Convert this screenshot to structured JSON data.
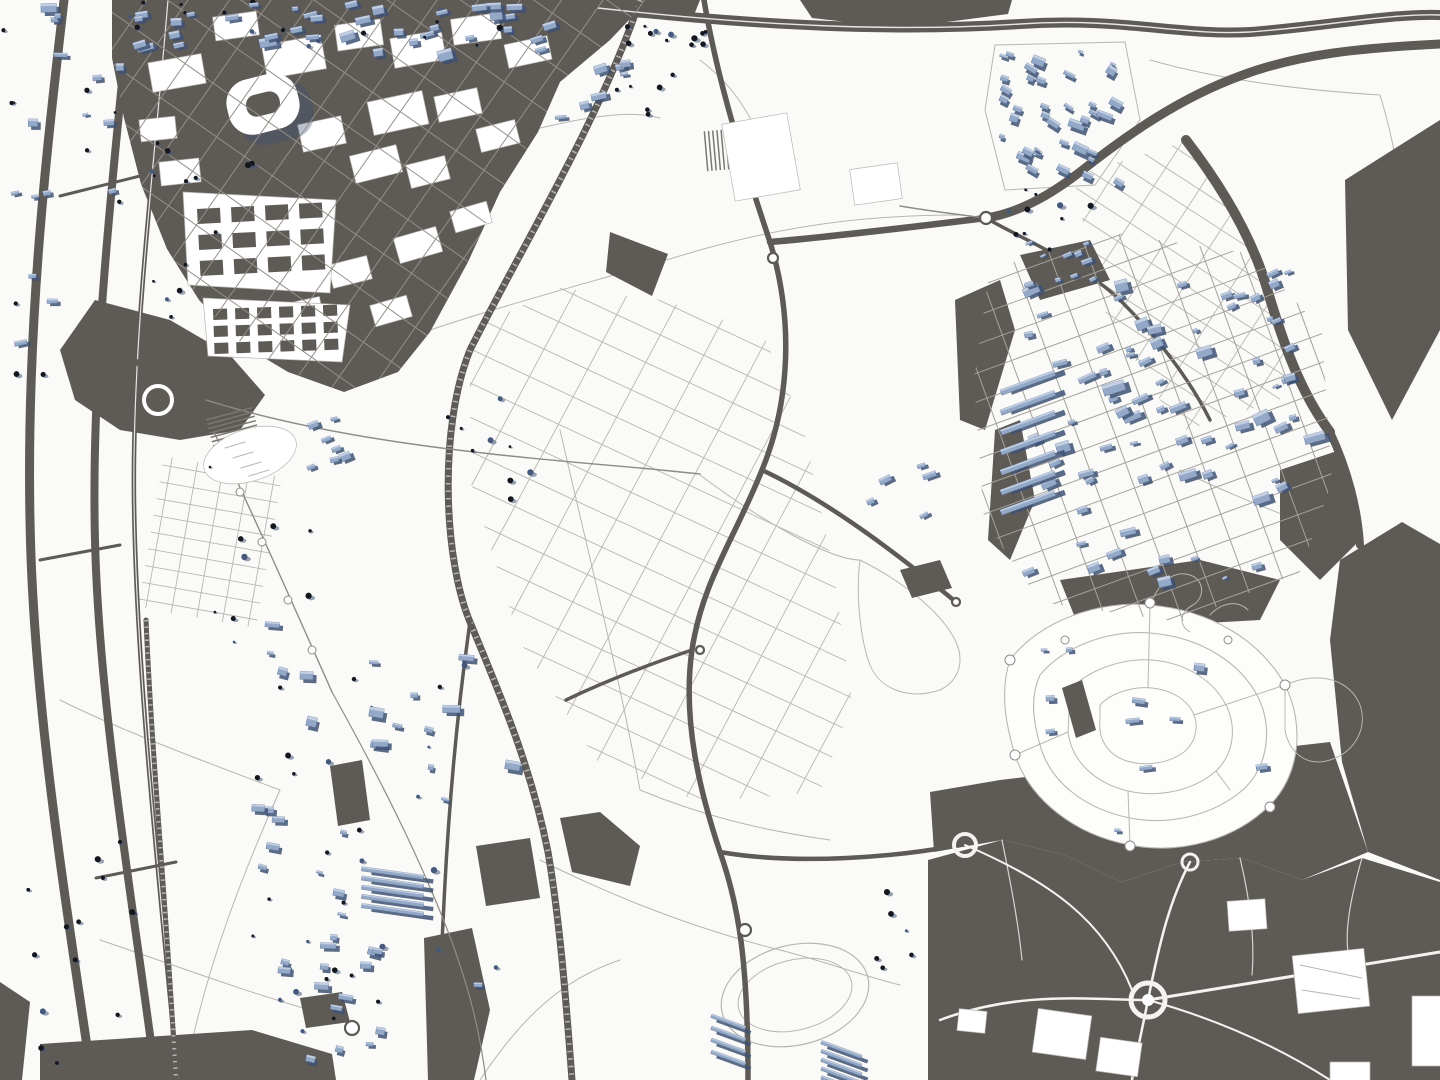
{
  "app": {
    "title": "Map"
  },
  "palette": {
    "bg": "#fafaf8",
    "fabric": "#5e5a56",
    "fabricDeep": "#4c4946",
    "lineLight": "#b8b6b1",
    "lineMid": "#8f8c87",
    "lineMed2": "#a5a29c",
    "lineHeavy": "#7b7873",
    "gridOnDark": "#93908a",
    "offWhite": "#f4f3f0",
    "bldg": "#94a8c7",
    "bldgLight": "#c9d3e3",
    "bldgShadow": "#3d5174",
    "treeDark": "#14171d",
    "treeBlue": "#46597b"
  },
  "map": {
    "seed": 1337,
    "layers": [
      "field-lines",
      "parcel-grids",
      "urban-fabric",
      "roads",
      "railways",
      "white-features",
      "suburb-streets",
      "buildings",
      "trees"
    ],
    "buildingClusters": [
      {
        "name": "top-strip-1",
        "x": 118,
        "y": 2,
        "w": 92,
        "h": 56,
        "n": 13,
        "minS": 5,
        "maxS": 11,
        "angle": -10,
        "type": "m"
      },
      {
        "name": "top-strip-2",
        "x": 212,
        "y": 2,
        "w": 118,
        "h": 48,
        "n": 15,
        "minS": 5,
        "maxS": 11,
        "angle": -10,
        "type": "m"
      },
      {
        "name": "top-strip-3",
        "x": 332,
        "y": 2,
        "w": 118,
        "h": 50,
        "n": 15,
        "minS": 5,
        "maxS": 11,
        "angle": -10,
        "type": "m"
      },
      {
        "name": "top-strip-4",
        "x": 452,
        "y": 2,
        "w": 108,
        "h": 54,
        "n": 13,
        "minS": 5,
        "maxS": 11,
        "angle": -10,
        "type": "m"
      },
      {
        "name": "left-column",
        "x": 76,
        "y": 62,
        "w": 46,
        "h": 150,
        "n": 9,
        "minS": 4,
        "maxS": 9,
        "angle": -8,
        "type": "m"
      },
      {
        "name": "corner-tl",
        "x": 2,
        "y": 2,
        "w": 66,
        "h": 120,
        "n": 8,
        "minS": 4,
        "maxS": 9,
        "angle": -6,
        "type": "m"
      },
      {
        "name": "left-corridor",
        "x": 6,
        "y": 170,
        "w": 54,
        "h": 220,
        "n": 9,
        "minS": 4,
        "maxS": 8,
        "angle": -6,
        "type": "m"
      },
      {
        "name": "mass-east",
        "x": 548,
        "y": 56,
        "w": 78,
        "h": 62,
        "n": 7,
        "minS": 4,
        "maxS": 9,
        "angle": -12,
        "type": "b"
      },
      {
        "name": "village-tr",
        "x": 1000,
        "y": 46,
        "w": 120,
        "h": 132,
        "n": 38,
        "minS": 3,
        "maxS": 9,
        "angle": 25,
        "type": "b"
      },
      {
        "name": "development",
        "x": 1016,
        "y": 262,
        "w": 288,
        "h": 318,
        "n": 80,
        "minS": 4,
        "maxS": 12,
        "angle": -20,
        "type": "b"
      },
      {
        "name": "dev-north",
        "x": 1025,
        "y": 240,
        "w": 80,
        "h": 40,
        "n": 8,
        "minS": 3,
        "maxS": 7,
        "angle": -20,
        "type": "b"
      },
      {
        "name": "dev-rows",
        "x": 1000,
        "y": 380,
        "w": 70,
        "h": 140,
        "n": 7,
        "minS": 5,
        "maxS": 9,
        "angle": -20,
        "type": "rows"
      },
      {
        "name": "suburb-sparse",
        "x": 1030,
        "y": 628,
        "w": 260,
        "h": 205,
        "n": 11,
        "minS": 4,
        "maxS": 8,
        "angle": 0,
        "type": "b"
      },
      {
        "name": "midleft-town",
        "x": 252,
        "y": 618,
        "w": 268,
        "h": 385,
        "n": 48,
        "minS": 4,
        "maxS": 11,
        "angle": 8,
        "type": "m"
      },
      {
        "name": "town-bl",
        "x": 268,
        "y": 928,
        "w": 132,
        "h": 142,
        "n": 24,
        "minS": 4,
        "maxS": 10,
        "angle": 8,
        "type": "m"
      },
      {
        "name": "terrace-rows",
        "x": 362,
        "y": 862,
        "w": 76,
        "h": 46,
        "n": 5,
        "minS": 6,
        "maxS": 7,
        "angle": 8,
        "type": "rows"
      },
      {
        "name": "rows-bc1",
        "x": 712,
        "y": 1008,
        "w": 44,
        "h": 48,
        "n": 4,
        "minS": 5,
        "maxS": 6,
        "angle": 20,
        "type": "rows"
      },
      {
        "name": "rows-bc2",
        "x": 822,
        "y": 1036,
        "w": 52,
        "h": 44,
        "n": 5,
        "minS": 5,
        "maxS": 6,
        "angle": 20,
        "type": "rows"
      },
      {
        "name": "center-compound",
        "x": 862,
        "y": 462,
        "w": 70,
        "h": 60,
        "n": 5,
        "minS": 4,
        "maxS": 8,
        "angle": -20,
        "type": "b"
      },
      {
        "name": "campus-cluster",
        "x": 282,
        "y": 418,
        "w": 66,
        "h": 54,
        "n": 7,
        "minS": 4,
        "maxS": 9,
        "angle": -15,
        "type": "b"
      }
    ],
    "treeClusters": [
      {
        "name": "park-topcenter",
        "x": 612,
        "y": 22,
        "w": 95,
        "h": 105,
        "n": 18
      },
      {
        "name": "mass-west-strip",
        "x": 150,
        "y": 118,
        "w": 110,
        "h": 215,
        "n": 14
      },
      {
        "name": "village-south",
        "x": 1002,
        "y": 182,
        "w": 115,
        "h": 68,
        "n": 10
      },
      {
        "name": "center-fields",
        "x": 428,
        "y": 378,
        "w": 105,
        "h": 145,
        "n": 9
      },
      {
        "name": "corridor-bl",
        "x": 18,
        "y": 838,
        "w": 125,
        "h": 235,
        "n": 14
      },
      {
        "name": "fields-bc",
        "x": 845,
        "y": 885,
        "w": 85,
        "h": 85,
        "n": 6
      },
      {
        "name": "promenade",
        "x": 208,
        "y": 430,
        "w": 130,
        "h": 260,
        "n": 10
      }
    ],
    "parcelGrids": [
      {
        "name": "center-fields-grid",
        "target": "grids-under",
        "clip": "clip-center",
        "bbox": [
          430,
          260,
          460,
          560
        ],
        "angles": [
          25,
          -62
        ],
        "spacings": [
          31,
          48
        ],
        "cls": "gl",
        "width": 0.9
      },
      {
        "name": "topright-grid",
        "target": "grids-under",
        "clip": "clip-tr",
        "bbox": [
          1050,
          120,
          270,
          330
        ],
        "angles": [
          33,
          -57
        ],
        "spacings": [
          22,
          40
        ],
        "cls": "gl",
        "width": 0.9
      },
      {
        "name": "orchard-grid",
        "target": "grids-under",
        "clip": "clip-orchard",
        "bbox": [
          130,
          450,
          160,
          185
        ],
        "angles": [
          10,
          100
        ],
        "spacings": [
          17,
          26
        ],
        "cls": "gl",
        "width": 0.9
      },
      {
        "name": "mass-street-grid",
        "target": "grids-over",
        "clip": "clip-mass",
        "bbox": [
          100,
          0,
          560,
          400
        ],
        "angles": [
          -55,
          35
        ],
        "spacings": [
          34,
          42
        ],
        "cls": "gm",
        "width": 1
      },
      {
        "name": "dev-street-grid",
        "target": "grids-over",
        "clip": "clip-dev",
        "bbox": [
          960,
          220,
          380,
          410
        ],
        "angles": [
          -20,
          70
        ],
        "spacings": [
          27,
          36
        ],
        "cls": "gl2",
        "width": 1
      }
    ],
    "blockGrids": [
      {
        "name": "campus-a-blocks",
        "x": 197,
        "y": 209,
        "cols": 4,
        "rows": 3,
        "cw": 23,
        "ch": 15,
        "gx": 11,
        "gy": 11,
        "angle": -3
      },
      {
        "name": "campus-b-blocks",
        "x": 213,
        "y": 309,
        "cols": 6,
        "rows": 3,
        "cw": 14,
        "ch": 11,
        "gx": 8,
        "gy": 6,
        "angle": -2
      }
    ],
    "stripeBlocks": [
      {
        "name": "vineyard-hatch",
        "x": 206,
        "y": 420,
        "count": 9,
        "gap": 4.5,
        "len": 48,
        "angle": -15
      },
      {
        "name": "compound-hatch",
        "x": 742,
        "y": 128,
        "count": 10,
        "gap": 4.2,
        "len": 40,
        "angle": 85
      }
    ]
  }
}
